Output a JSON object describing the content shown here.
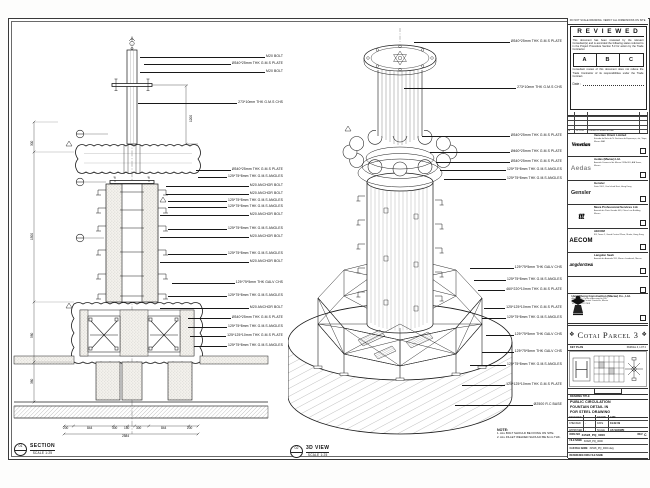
{
  "sheet": {
    "section_view": {
      "marker": "01",
      "title": "SECTION",
      "scale": "SCALE 1:25",
      "annotations": [
        "M20 BOLT",
        "Ø340*25mm THK G.M.S PLATE",
        "M20 BOLT",
        "273*10mm THK G.M.S CHS",
        "Ø340*25mm THK G.M.S PLATE",
        "125*75*8mm THK G.M.S ANGLES",
        "M20 ANCHOR BOLT",
        "M20 ANCHOR BOLT",
        "125*75*8mm THK G.M.S ANGLES",
        "125*75*8mm THK G.M.S ANGLES",
        "M20 ANCHOR BOLT",
        "125*75*8mm THK G.M.S ANGLES",
        "M20 ANCHOR BOLT",
        "125*75*8mm THK G.M.S ANGLES",
        "M20 ANCHOR BOLT",
        "125*75*5mm THK GALV CHS",
        "125*75*8mm THK G.M.S ANGLES",
        "M20 ANCHOR BOLT",
        "Ø340*25mm THK G.M.S PLATE",
        "125*75*8mm THK G.M.S ANGLES",
        "125*125*10mm THK G.M.S PLATE",
        "125*75*8mm THK G.M.S ANGLES"
      ],
      "dims": {
        "vertical": [
          "300",
          "1500",
          "580",
          "380"
        ],
        "pole": "1200",
        "chain": [
          "200",
          "844",
          "300",
          "150",
          "300",
          "844",
          "200"
        ],
        "overall": "2584"
      }
    },
    "iso_view": {
      "marker": "02",
      "title": "3D VIEW",
      "scale": "SCALE 1:25",
      "annotations": [
        "Ø340*25mm THK G.M.S PLATE",
        "273*10mm THK G.M.S CHS",
        "Ø340*25mm THK G.M.S PLATE",
        "Ø460*25mm THK G.M.S PLATE",
        "Ø340*25mm THK G.M.S PLATE",
        "125*75*8mm THK G.M.S ANGLES",
        "125*75*8mm THK G.M.S ANGLES",
        "125*75*5mm THK GALV CHS",
        "125*75*8mm THK G.M.S ANGLES",
        "460*220*10mm THK G.M.S PLATE",
        "125*125*10mm THK G.M.S PLATE",
        "125*75*8mm THK G.M.S ANGLES",
        "125*75*5mm THK GALV CHS",
        "125*75*5mm THK GALV CHS",
        "125*75*8mm THK G.M.S ANGLES",
        "125*125*10mm THK G.M.S PLATE",
        "Ø2500 R.C BASE"
      ]
    },
    "notes": {
      "heading": "NOTE:",
      "items": [
        "1. ALL BOLT SHOULD BE FIXING ON SITE.",
        "2. ALL FILLET WELDED SHOULD BE 6mm THK."
      ]
    }
  },
  "title_block": {
    "no_scale": "DO NOT SCALE DRAWING. VERIFY ALL DIMENSIONS ON SITE.",
    "reviewed": {
      "title": "R E V I E W E D",
      "para1": "This document has been reviewed by the relevant Consultant(s) and is accorded the following status referred to in the Project Procedure Section 5.3 for action by the Trade Contractor.",
      "options": [
        "A",
        "B",
        "C"
      ],
      "para2": "Consultant review of this document does not relieve the Trade Contractor of its responsibilities under the Trade Contract.",
      "date_label": "Date :"
    },
    "revision_table": {
      "header": [
        "REV",
        "DATE",
        "DESCRIPTION"
      ],
      "entries": [
        [
          "A",
          "14.11.08",
          "ISSUED FOR APPROVAL"
        ]
      ]
    },
    "consultants": [
      {
        "logo": "Venetian",
        "name": "Venetian Orient Limited",
        "address": "Estrada da Baía de N. Senhora da Esperança, s/n, Taipa, Macau SAR"
      },
      {
        "logo": "Aedas",
        "name": "Aedas (Macau) Ltd.",
        "address": "Avenida Comercial de Macau 251A-301, AIA Tower, Macau"
      },
      {
        "logo": "Gensler",
        "name": "Gensler",
        "address": "Suite 1901, One Island East, Hong Kong"
      },
      {
        "logo": "ttt",
        "name": "Meca Professional Services Ltd.",
        "address": "Avenida da Praia Grande 409, China Law Building, Macau"
      },
      {
        "logo": "AECOM",
        "name": "AECOM",
        "address": "8/F, Tower 2, Grand Central Plaza, Shatin, Hong Kong"
      },
      {
        "logo": "LangdonSeah",
        "name": "Langdon Seah",
        "address": "Avenida da Amizade 555, Macau Landmark, Macau"
      }
    ],
    "contractor": {
      "name": "Hsin Chong Construction (Macau) Co., Ltd.",
      "address_lines": [
        "Alameda Dr. Carlos d'Assumpção 180,",
        "Tong Nam Ah Central Comércio, Macau",
        "Tel (853) 2872 2308"
      ]
    },
    "project": {
      "label": "PROJECT TITLE",
      "title": "Cotai Parcel 3"
    },
    "key_plan": {
      "label": "KEY PLAN",
      "note": "PARCEL 3, LOT 2"
    },
    "drawing": {
      "label": "DRAWING TITLE",
      "title_lines": [
        "PUBLIC CIRCULATION",
        "FOUNTAIN DETAIL IN",
        "FOR STEEL DRAWING"
      ],
      "fields": [
        [
          "DESIGNED",
          "",
          "DRAWN",
          "LMC"
        ],
        [
          "CHECKED",
          "-",
          "DATE",
          "19.02.09"
        ],
        [
          "APPROVED",
          "-",
          "SCALE",
          "AS SHOWN"
        ]
      ],
      "dwg_no_label": "DWG NO",
      "dwg_no": "31528_PQ_0000",
      "rev_label": "REV",
      "rev": "C",
      "file_rows": [
        [
          "FILE NAME",
          "31528_PQ_0000"
        ],
        [
          "CAD FILE NAME",
          "31528_PQ_0000.dwg"
        ],
        [
          "REFERENCE DWG FILE NAME",
          ""
        ]
      ]
    }
  }
}
